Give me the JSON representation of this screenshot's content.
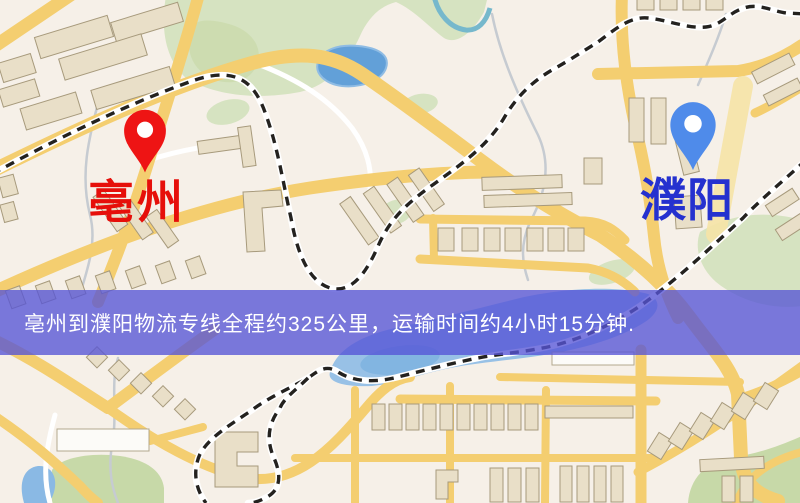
{
  "markers": {
    "origin": {
      "label": "亳州"
    },
    "destination": {
      "label": "濮阳"
    }
  },
  "banner": {
    "text": "亳州到濮阳物流专线全程约325公里，运输时间约4小时15分钟."
  },
  "route_info": {
    "distance_text": "约325公里",
    "duration_text": "约4小时15分钟"
  },
  "theme": {
    "map-bg": "#f6f0e8",
    "road-yellow": "#f4ce70",
    "road-pale": "#f6e3a6",
    "park-green": "#d6e3c1",
    "park-green-dark": "#c7d9a8",
    "water-blue": "#62a0d8",
    "river-blue": "#98c1e6",
    "building-fill": "#e9dfc8",
    "building-stroke": "#a79a7c",
    "railway-dark": "#24221f",
    "stream-gray": "#c6cbd1",
    "banner-bg": "rgba(86,84,214,0.78)",
    "banner-text-color": "#ffffff",
    "origin-label-color": "#e60f0a",
    "origin-pin-color": "#ee1414",
    "destination-label-color": "#2531cf",
    "destination-pin-color": "#4f8bea"
  }
}
